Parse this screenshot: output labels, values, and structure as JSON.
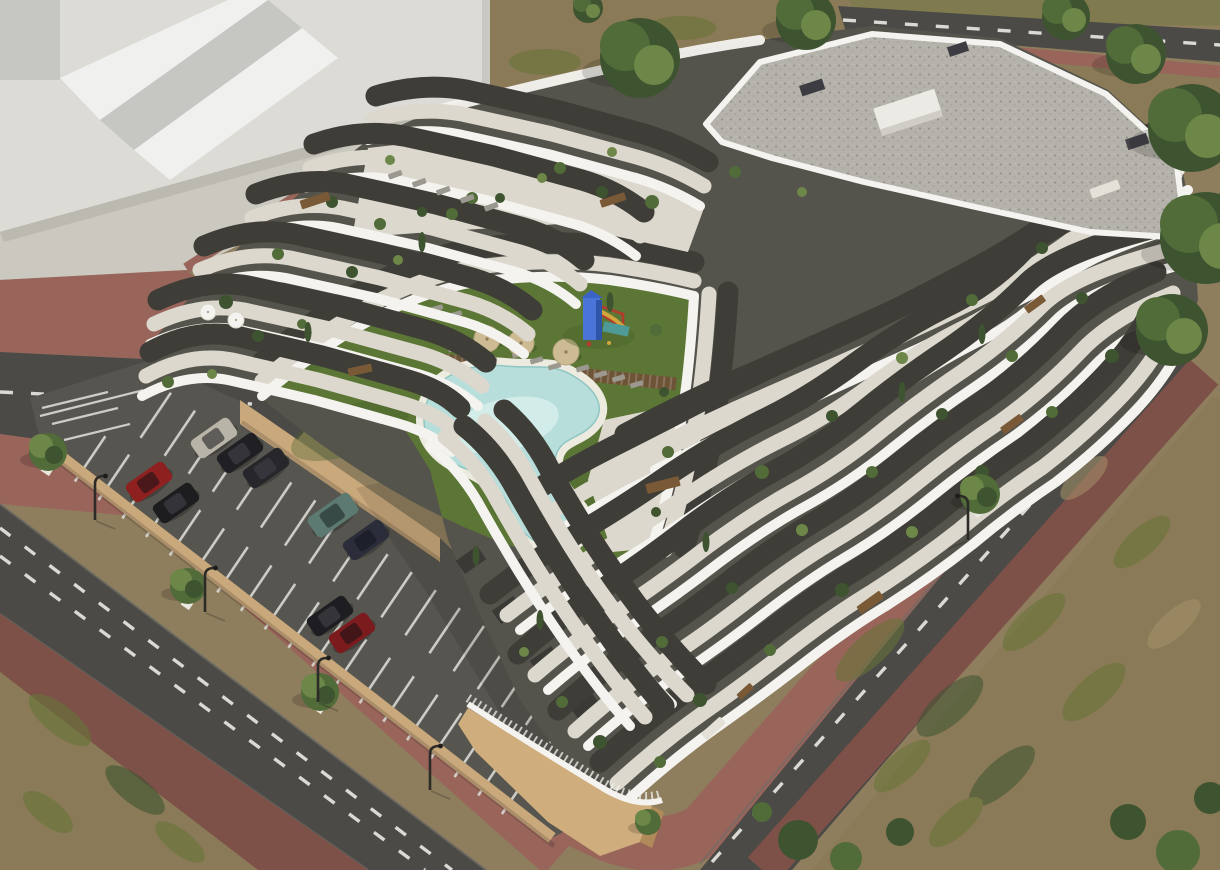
{
  "scene": {
    "type": "aerial-3d-architectural-rendering",
    "subject": "terraced-white-apartment-complex",
    "alt": "Aerial 3D architectural rendering of a terraced white apartment building with wavy balconies, a courtyard lawn with freeform swimming pool and playground, a striped parking lot with cars, surrounding roads with red-brick sidewalks, street lamps and trees",
    "time_of_day": "day",
    "features": [
      "gravel-flat-roof",
      "wavy-white-balcony-bands",
      "roof-terraces-with-plants",
      "courtyard-lawn",
      "freeform-pool",
      "wood-deck-walkway",
      "parasols",
      "sun-loungers",
      "playground-slide",
      "parking-lot",
      "retaining-walls",
      "street-trees",
      "street-lamps",
      "neighboring-massing-volume"
    ],
    "counts": {
      "parasols": 3,
      "white-parasols": 2,
      "cars": 9,
      "street_lamps": 5,
      "pools": 1,
      "playgrounds": 1,
      "street_trees": 4
    }
  },
  "palette": {
    "bg": "#8f7e5e",
    "dirt": "#8a7a57",
    "olive": "#7f7b4f",
    "grassPatch": "#667438",
    "tanPatch": "#a5926a",
    "massWall": "#dcdbd6",
    "massTop": "#f0f0ee",
    "massSide": "#c6c6c2",
    "apron": "#cbc8bf",
    "road": "#4b4a46",
    "dash": "#ebe9e2",
    "walk": "#99655b",
    "walkDark": "#7d5048",
    "curb": "#6d6c66",
    "park": "#56554f",
    "stall": "#dad9d3",
    "wallTan": "#c9a87c",
    "wallTanDark": "#a8875b",
    "lawn": "#5b7635",
    "lawnDark": "#48622a",
    "pool": "#b7dedb",
    "poolLight": "#daf0ee",
    "poolDeck": "#edebe0",
    "wood": "#6e5437",
    "white": "#f4f3ef",
    "floor": "#dcd8cd",
    "mass": "#55544c",
    "window": "#3e3d37",
    "gravel": "#b4b2aa",
    "gravelDot": "#908e87",
    "podium": "#d0ad7c",
    "podiumSide": "#b08a58",
    "treeDark": "#3e5430",
    "tree": "#516b39",
    "treeLight": "#6d8749",
    "lounger": "#9b988f",
    "furn": "#7a5937",
    "sofa": "#e4e1d8",
    "umb": "#cdbb94",
    "playBlue": "#4a74d8",
    "playBlueDark": "#2f55a8",
    "playRed": "#b23b2e",
    "playYellow": "#d2a63c",
    "playTeal": "#4e9a96"
  },
  "parking": {
    "stall_marking": "white-lines",
    "cars": [
      {
        "name": "silver-car",
        "color": "#b9b4a8"
      },
      {
        "name": "black-car",
        "color": "#202024"
      },
      {
        "name": "black-sedan",
        "color": "#26262b"
      },
      {
        "name": "red-hatchback",
        "color": "#8e2020"
      },
      {
        "name": "black-hatchback",
        "color": "#1d1d20"
      },
      {
        "name": "teal-suv",
        "color": "#5d7a72"
      },
      {
        "name": "dark-blue-sedan",
        "color": "#2b2e3a"
      },
      {
        "name": "black-car-2",
        "color": "#1e1e22"
      },
      {
        "name": "dark-red-car",
        "color": "#7c1b1e"
      }
    ]
  },
  "courtyard": {
    "pool": {
      "shape": "freeform",
      "water_color": "#b7dedb"
    },
    "parasol_color": "#cdbb94",
    "playground": {
      "tower_color": "#4a74d8",
      "slide_color": "#d2a63c",
      "accent_color": "#b23b2e"
    }
  },
  "building": {
    "balcony_style": "curved-white-bands",
    "facade_color": "#55544c",
    "roof": "gravel-flat-roof",
    "base_color": "#d0ad7c"
  }
}
